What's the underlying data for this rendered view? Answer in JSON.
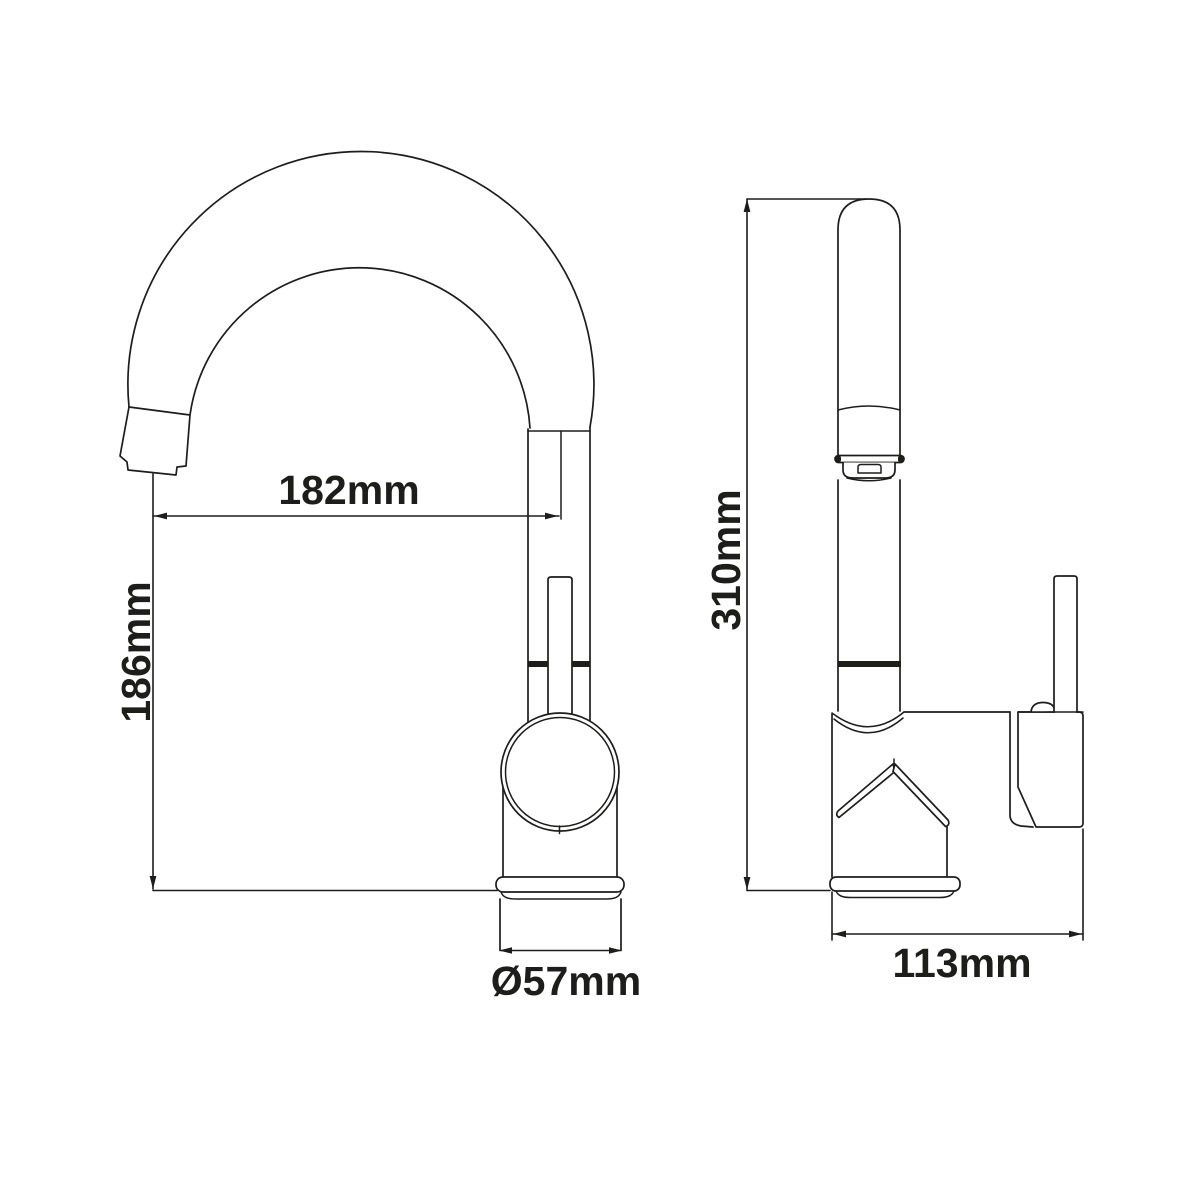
{
  "drawing": {
    "background": "#ffffff",
    "line_color": "#1d1d1b"
  },
  "dimensions": {
    "spout_reach": "182mm",
    "spout_height": "186mm",
    "base_diameter": "Ø57mm",
    "overall_height": "310mm",
    "body_width": "113mm"
  }
}
